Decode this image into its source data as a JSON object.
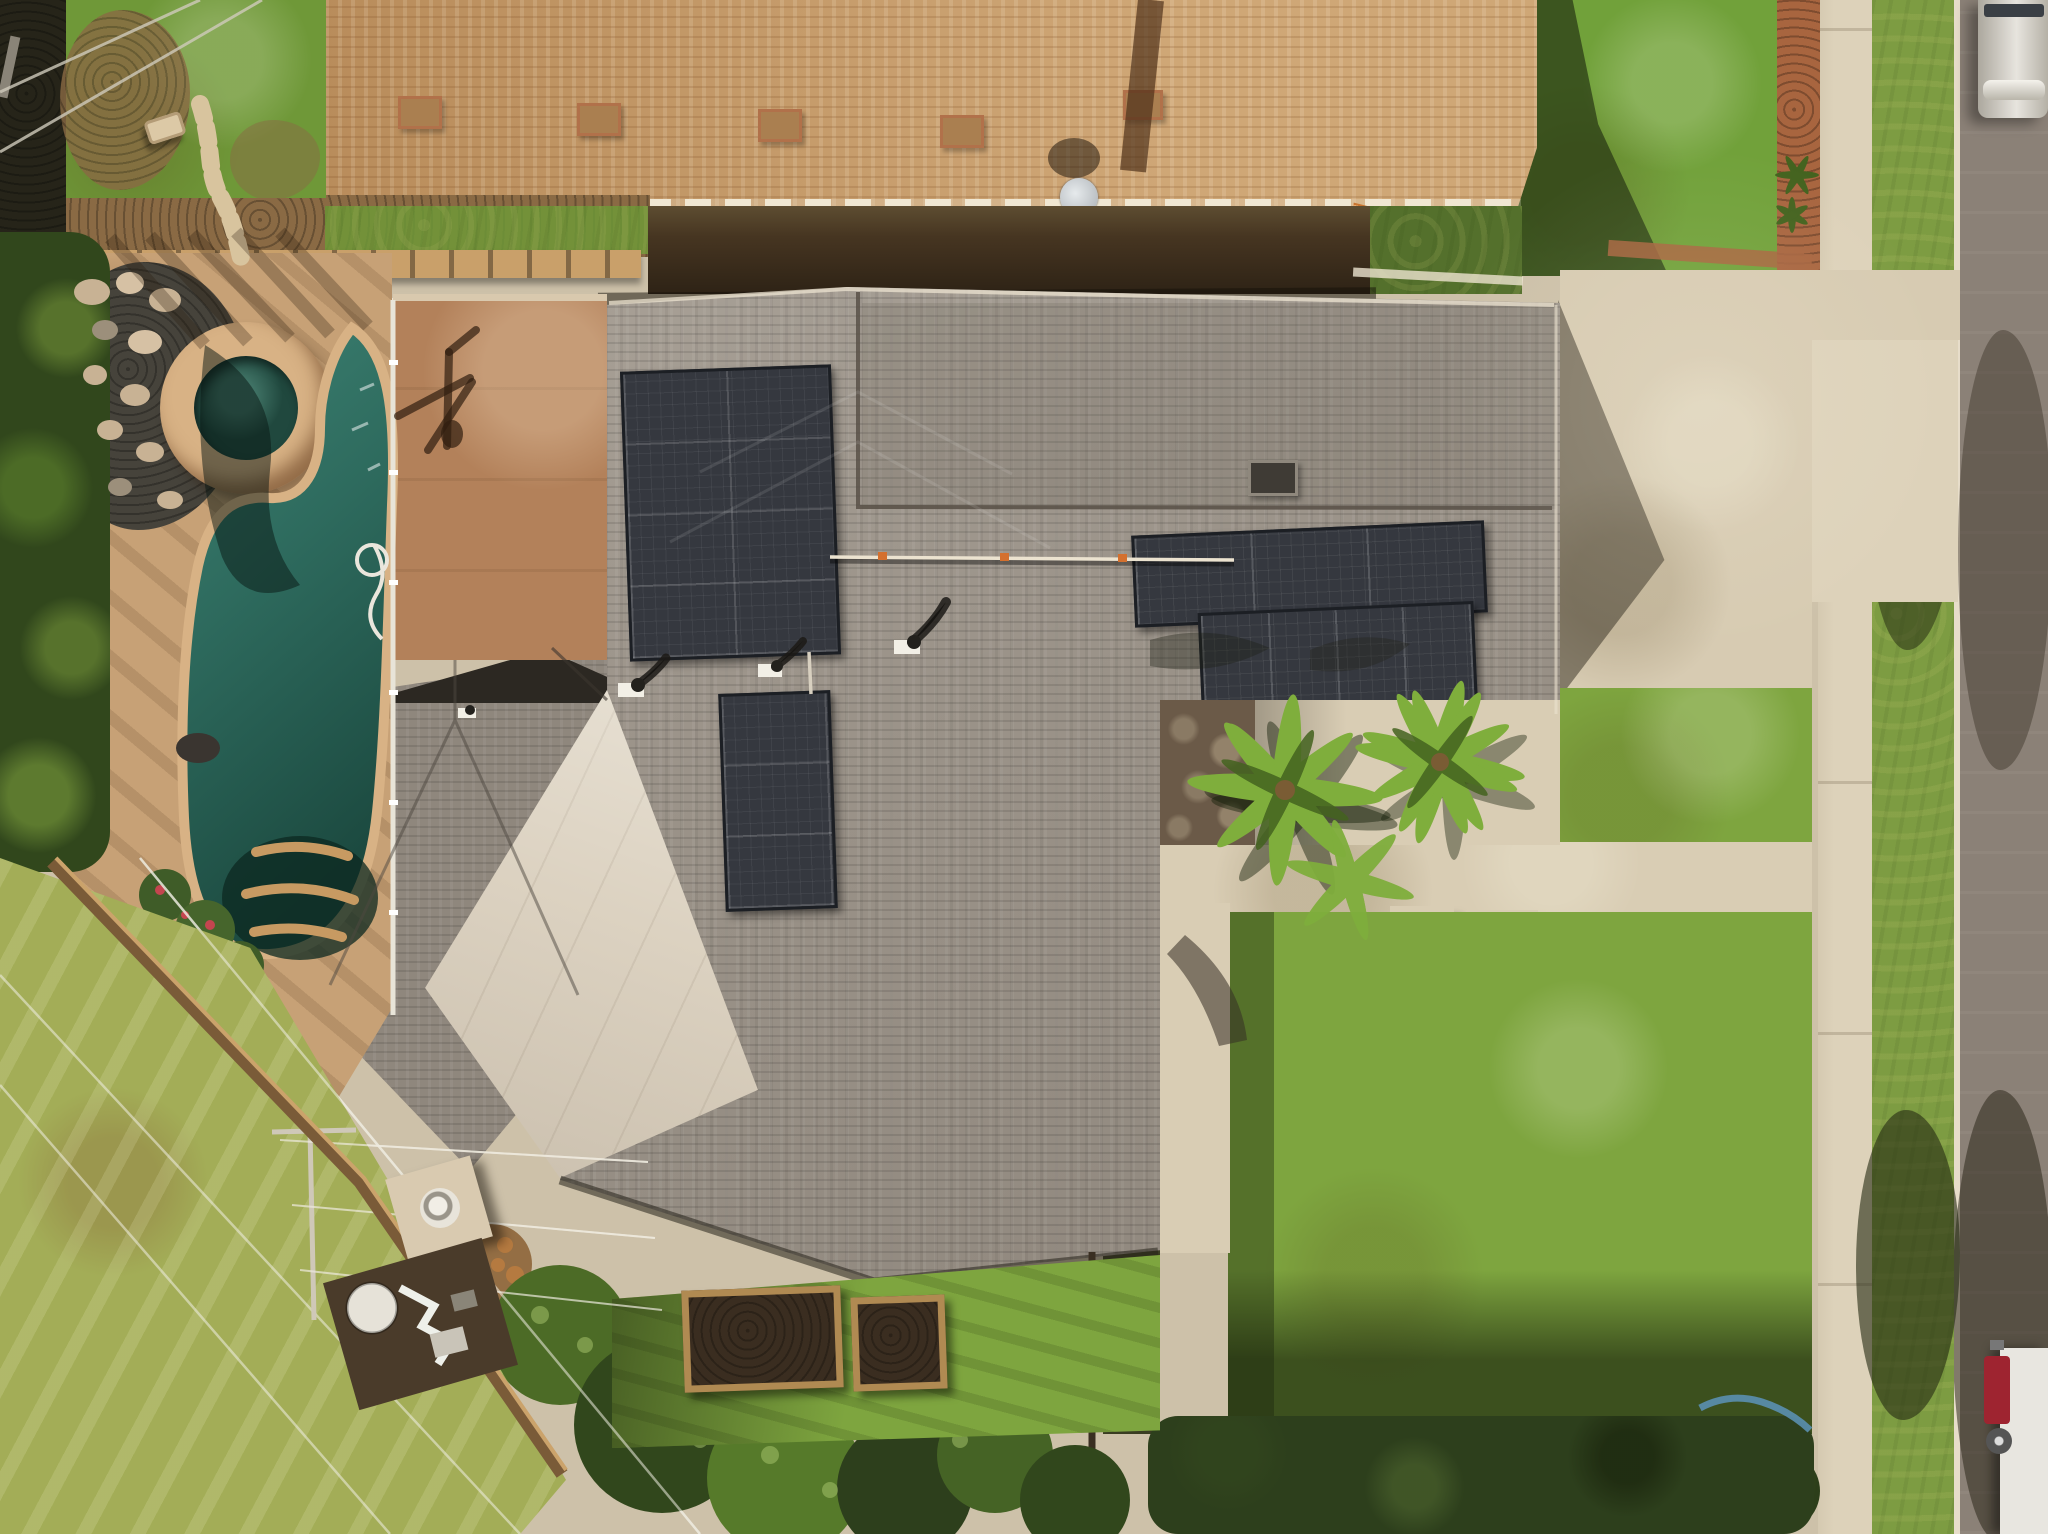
{
  "scene": {
    "type": "aerial-drone-photograph",
    "description": "Top-down drone view of a suburban home with weathered gray shingle roof and rooftop solar panel arrays, a free-form swimming pool with round spa and rock waterfall in the left backyard, a flat brown patio-cover roof, front courtyard with palm trees, concrete driveway and walkways, large front and rear lawns, a neighboring house with tan shingle roof at top, and a street with parked trucks along the right edge.",
    "time_of_day": "late afternoon, long shadows, warm sunlight",
    "palette": {
      "base": "#cdc1a9",
      "street": "#8b8177",
      "curb": "#e7ddca",
      "sidewalk": "#ddd2ba",
      "concrete": "#d9cdb4",
      "driveway": "#d7cbb2",
      "grass_bright": "#71a13a",
      "grass_front": "#7ea53f",
      "grass_parkway": "#7d9c42",
      "grass_yellow": "#a3ad57",
      "grass_strip": "#6f9838",
      "roof_tan": "#c69965",
      "roof_tan_dark": "#aa7f50",
      "roof_gray": "#9b9389",
      "roof_gray_dark": "#8f877d",
      "roof_cream": "#dcd2c1",
      "roof_brown_flat": "#b3815a",
      "solar_panel": "#35383f",
      "hedge_dark": "#463521",
      "hedge_green": "#54702c",
      "hedge_row": "#2d3f1c",
      "dirt": "#8a6a44",
      "pergola_wood": "#c9a06a",
      "pool_deck": "#c7a176",
      "pool_coping": "#d8b285",
      "pool_light": "#3d8273",
      "pool_dark": "#1c4a40",
      "spa_water": "#20483e",
      "pebble_bed": "#46433b",
      "boulder": "#c8b294",
      "dark_foliage": "#262419",
      "tree_green": "#4c6b26",
      "tree_dark": "#31471c",
      "palm_green": "#7fae3c",
      "palm_dark": "#44631f",
      "stone_wall": "#6b5a48",
      "bed_soil": "#3a2d20",
      "bed_wood": "#b08a52",
      "truck_silver": "#cfc9bd",
      "truck_red": "#9e2430",
      "truck_white": "#e8e6e0",
      "brick_edge": "#a8653f",
      "white_trim": "#ece3d0"
    },
    "objects": [
      {
        "name": "neighbor-tan-roof",
        "desc": "large tan asphalt-shingle roof across the top with vents, chimney shadow and satellite dish"
      },
      {
        "name": "main-gray-roof",
        "desc": "subject house weathered gray shingle roof, L-shaped with hips, ridges and conduit"
      },
      {
        "name": "solar-array-upper",
        "desc": "2x4 black solar panel array on upper west plane"
      },
      {
        "name": "solar-array-lower",
        "desc": "2x3 black solar panel array below the upper array"
      },
      {
        "name": "solar-array-wing-1",
        "desc": "3-panel landscape solar row on east wing"
      },
      {
        "name": "solar-array-wing-2",
        "desc": "4-panel solar row offset below on east wing"
      },
      {
        "name": "patio-cover-brown-roof",
        "desc": "flat brown roof section over rear patio with antenna shadow"
      },
      {
        "name": "cream-flat-roof-diamond",
        "desc": "light cream diamond-shaped flat roof plane at lower-left of house"
      },
      {
        "name": "tower-hip-roof",
        "desc": "small gray hip roof over rear left room"
      },
      {
        "name": "pool",
        "desc": "free-form teal swimming pool with steps, white cleaning hose, tree shadows"
      },
      {
        "name": "spa",
        "desc": "round raised spa with tan stone coping and dark green water"
      },
      {
        "name": "rock-waterfall",
        "desc": "boulder and pebble waterfall feature beside the spa"
      },
      {
        "name": "courtyard-palms",
        "desc": "palm trees in front courtyard over flagstone wall"
      },
      {
        "name": "front-lawn",
        "desc": "large front lawn framed by concrete walkways"
      },
      {
        "name": "driveway",
        "desc": "concrete driveway with curb apron at top right"
      },
      {
        "name": "sidewalk-parkway-street",
        "desc": "vertical sidewalk, grass parkway and asphalt street along right edge"
      },
      {
        "name": "silver-pickup-truck",
        "desc": "silver pickup parked on street, top right"
      },
      {
        "name": "red-white-truck",
        "desc": "red-cab box truck parked on street, bottom right"
      },
      {
        "name": "garden-beds",
        "desc": "two raised wooden garden beds with dark soil behind house"
      },
      {
        "name": "pool-equipment-pad",
        "desc": "pool equipment with white tank and pipes at lower left of house"
      },
      {
        "name": "outdoor-chimney",
        "desc": "beige chimney cap with round vent behind house"
      },
      {
        "name": "utility-wires",
        "desc": "overhead utility lines crossing bottom-left yard"
      },
      {
        "name": "hedges-trees",
        "desc": "dense hedge row and trees along bottom boundary"
      },
      {
        "name": "garden-hose-blue",
        "desc": "coiled blue garden hose near bottom hedge"
      }
    ]
  }
}
